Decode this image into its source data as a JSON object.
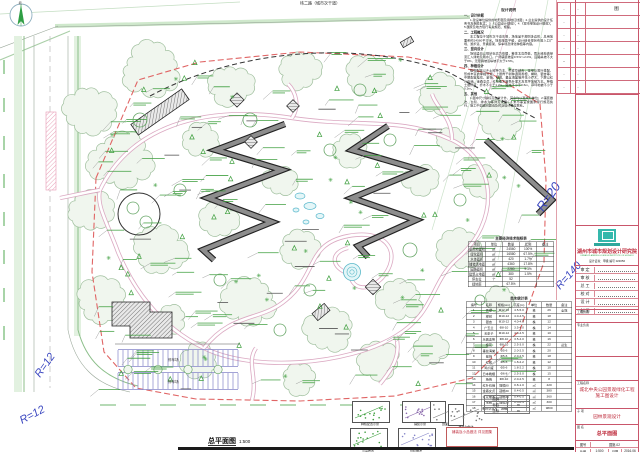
{
  "plan": {
    "title": "总平面图",
    "scale": "1:500",
    "north_label": "北",
    "top_road_label": "纬二路（城市次干道）",
    "parking_label": "停车场",
    "radius_labels": [
      {
        "text": "R=12"
      },
      {
        "text": "R=12"
      },
      {
        "text": "R=20"
      },
      {
        "text": "R=140"
      }
    ]
  },
  "notes": {
    "title": "设计说明",
    "sections": [
      {
        "heading": "一、设计依据",
        "body": "1.建设单位提供的地形图及用地红线图；2.业主提供的设计任务书及相关批文；3.《公园设计规范》；4.《城市绿地设计规范》；5.国家及地方现行有关规范、规程。"
      },
      {
        "heading": "二、工程概况",
        "body": "本工程位于城市次干道东侧，场地呈不规则多边形，总用地面积约24560平方米。场地地势平缓，设计结合现状布置入口广场、游步道、景墙廊架、停车场及绿化种植等内容。"
      },
      {
        "heading": "三、竖向设计",
        "body": "场地竖向以现状标高为依据，整体北高南低，雨水经地表径流汇入绿地及雨水口。广场铺装坡度0.5%～2.0%，园路纵坡不大于8%，无障碍坡道纵坡不大于2.5%。"
      },
      {
        "heading": "四、种植设计",
        "body": "植物配置以乡土树种为主，乔灌草结合，常绿与落叶搭配，形成丰富的季相景观。上层骨干树种选用香樟、榉树、银杏等；中层配置桂花、紫薇、红枫、垂丝海棠等开花小乔木；下层以红叶石楠、金森女贞、红花檵木等色叶灌木及草坪地被为主。种植土层厚度：乔木不小于1.2m，灌木不小于0.6m，草坪地被不小于0.3m。"
      },
      {
        "heading": "五、其他",
        "body": "1.图中尺寸除标高以米计外，其余均以毫米为单位；2.铺装做法、台阶、排水沟等详见详图；3.未尽事宜按国家现行规范执行，施工中如遇问题请及时与设计单位联系。"
      }
    ]
  },
  "indicator_table": {
    "title": "主要经济技术指标表",
    "columns": [
      "项目",
      "单位",
      "数量",
      "比例",
      "备注"
    ],
    "rows": [
      [
        "总用地面积",
        "㎡",
        "24560",
        "100%",
        ""
      ],
      [
        "绿化面积",
        "㎡",
        "16580",
        "67.5%",
        ""
      ],
      [
        "水体面积",
        "㎡",
        "420",
        "1.7%",
        ""
      ],
      [
        "铺装场地面积",
        "㎡",
        "4360",
        "17.8%",
        ""
      ],
      [
        "园路面积",
        "㎡",
        "2280",
        "9.3%",
        ""
      ],
      [
        "建筑占地面积",
        "㎡",
        "380",
        "1.5%",
        ""
      ],
      [
        "停车位",
        "个",
        "52",
        "",
        ""
      ],
      [
        "绿地率",
        "",
        "67.5%",
        "",
        ""
      ]
    ]
  },
  "plant_table": {
    "title": "苗木统计表",
    "columns": [
      "编号",
      "名称",
      "规格(cm)",
      "高度(m)",
      "单位",
      "数量",
      "备注"
    ],
    "rows": [
      [
        "1",
        "香樟",
        "Φ12-15",
        "4.5-5.0",
        "株",
        "26",
        "全冠"
      ],
      [
        "2",
        "榉树",
        "Φ10-12",
        "4.0-4.5",
        "株",
        "18",
        ""
      ],
      [
        "3",
        "银杏",
        "Φ10-12",
        "4.0-4.5",
        "株",
        "12",
        ""
      ],
      [
        "4",
        "广玉兰",
        "Φ8-10",
        "3.5-4.0",
        "株",
        "14",
        ""
      ],
      [
        "5",
        "无患子",
        "Φ10-12",
        "4.0-4.5",
        "株",
        "10",
        ""
      ],
      [
        "6",
        "乐昌含笑",
        "Φ8-10",
        "3.5-4.0",
        "株",
        "16",
        ""
      ],
      [
        "7",
        "桂花",
        "Φ8-10",
        "2.5-3.0",
        "株",
        "22",
        "丛生"
      ],
      [
        "8",
        "垂丝海棠",
        "Φ5-6",
        "2.0-2.5",
        "株",
        "20",
        ""
      ],
      [
        "9",
        "紫薇",
        "Φ5-6",
        "2.0-2.5",
        "株",
        "18",
        ""
      ],
      [
        "10",
        "红枫",
        "Φ5-6",
        "1.8-2.2",
        "株",
        "12",
        ""
      ],
      [
        "11",
        "鸡爪槭",
        "Φ5-6",
        "1.8-2.2",
        "株",
        "10",
        ""
      ],
      [
        "12",
        "日本晚樱",
        "Φ6-8",
        "2.5-3.0",
        "株",
        "15",
        ""
      ],
      [
        "13",
        "杨梅",
        "Φ8-10",
        "2.0-2.5",
        "株",
        "8",
        ""
      ],
      [
        "14",
        "红叶石楠",
        "冠幅80",
        "0.8-1.0",
        "㎡",
        "420",
        ""
      ],
      [
        "15",
        "金森女贞",
        "冠幅30",
        "0.4-0.5",
        "㎡",
        "380",
        ""
      ],
      [
        "16",
        "红花檵木",
        "冠幅30",
        "0.4-0.5",
        "㎡",
        "360",
        ""
      ],
      [
        "17",
        "毛鹃",
        "冠幅30",
        "0.3-0.4",
        "㎡",
        "300",
        ""
      ],
      [
        "18",
        "果岭草草坪",
        "满铺",
        "",
        "㎡",
        "9800",
        ""
      ]
    ]
  },
  "revision_table": {
    "rows": [
      [
        "·",
        "·",
        "图"
      ],
      [
        "·",
        "·",
        ""
      ],
      [
        "·",
        "·",
        ""
      ],
      [
        "·",
        "·",
        ""
      ],
      [
        "··",
        "",
        ""
      ],
      [
        "·",
        "·",
        ""
      ],
      [
        "·",
        "·",
        ""
      ]
    ]
  },
  "legend": {
    "items": [
      {
        "label": "种植配置示意"
      },
      {
        "label": "铺装示意"
      },
      {
        "label": "剖面示意"
      },
      {
        "label": "小品布置"
      },
      {
        "label": "台阶做法"
      },
      {
        "label": "排水沟做法"
      }
    ],
    "note_box": "铺装及小品做法 详见图集",
    "minitable": {
      "rows": [
        [
          "图例",
          ""
        ],
        [
          "标高",
          "m"
        ],
        [
          "坐标",
          "m"
        ]
      ]
    }
  },
  "titleblock": {
    "company": "湖州市城市规划设计研究院",
    "company_en": "URBAN PLANNING & DESIGN INSTITUTE OF HUZHOU",
    "cert": "设计证书：甲级  编号 023056",
    "personnel": [
      {
        "label": "审 定"
      },
      {
        "label": "审 核"
      },
      {
        "label": "总 工"
      },
      {
        "label": "校 对"
      },
      {
        "label": "设 计"
      },
      {
        "label": "制 图"
      }
    ],
    "extra_row_1": "工程负责",
    "extra_row_2": "专业负责",
    "project_label": "工程名称",
    "project_name_1": "城北中央公园景观绿化工程",
    "project_name_2": "施工图设计",
    "subitem_label": "子 项",
    "subitem": "园林景观设计",
    "sheetname_label": "图 名",
    "sheet_name": "总平面图",
    "footer": {
      "no_label": "图号",
      "no": "园施-02",
      "scale_label": "比例",
      "scale": "1:500",
      "date_label": "日期",
      "date": "2016.06"
    }
  }
}
